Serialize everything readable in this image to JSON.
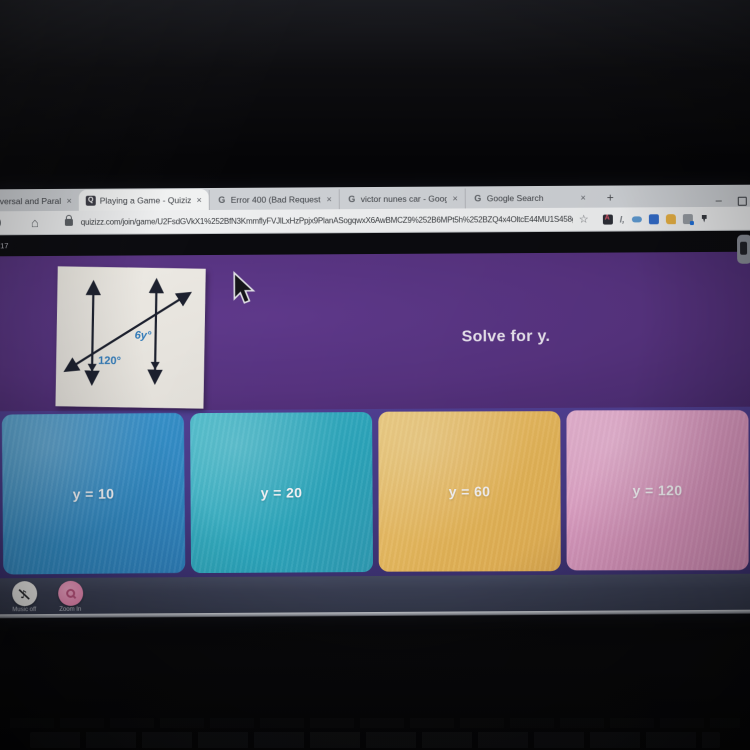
{
  "browser": {
    "tabs": [
      {
        "title": "versal and Parallel Li",
        "active": false,
        "favicon": "none"
      },
      {
        "title": "Playing a Game - Quizizz",
        "active": true,
        "favicon": "quizizz"
      },
      {
        "title": "Error 400 (Bad Request)!!1",
        "active": false,
        "favicon": "google"
      },
      {
        "title": "victor nunes car - Google Search",
        "active": false,
        "favicon": "google"
      },
      {
        "title": "Google Search",
        "active": false,
        "favicon": "google"
      }
    ],
    "glyphs": {
      "close": "×",
      "new_tab": "+",
      "minimize": "–",
      "favicon_quizizz": "Q",
      "favicon_google": "G",
      "bookmark_star": "☆",
      "home": "⌂",
      "music_note": "♪"
    },
    "address_bar": {
      "url": "quizizz.com/join/game/U2FsdGVkX1%252BfN3KmmflyFVJlLxHzPpjx9PlanASogqwxX6AwBMCZ9%252B6MPt5h%252BZQ4x4OltcE44MU1S458gk07Xg%253D%253.."
    }
  },
  "game": {
    "question_counter": "/17",
    "prompt": "Solve for y.",
    "diagram": {
      "description": "two parallel lines cut by a transversal",
      "angle_left": "120°",
      "angle_right": "6y°"
    },
    "answers": [
      {
        "label": "y = 10",
        "color": "#2f93d3"
      },
      {
        "label": "y = 20",
        "color": "#26aec7"
      },
      {
        "label": "y = 60",
        "color": "#f4bd54"
      },
      {
        "label": "y = 120",
        "color": "#ea9cca"
      }
    ],
    "controls": [
      {
        "label": "Music off"
      },
      {
        "label": "Zoom In"
      }
    ]
  },
  "colors": {
    "question_bg": "#5b3489",
    "answers_bg": "#473a8c",
    "bottom_bar": "#3a4056",
    "zoom_button_pink": "#ef87b5",
    "diagram_label_blue": "#2d7fc4"
  }
}
